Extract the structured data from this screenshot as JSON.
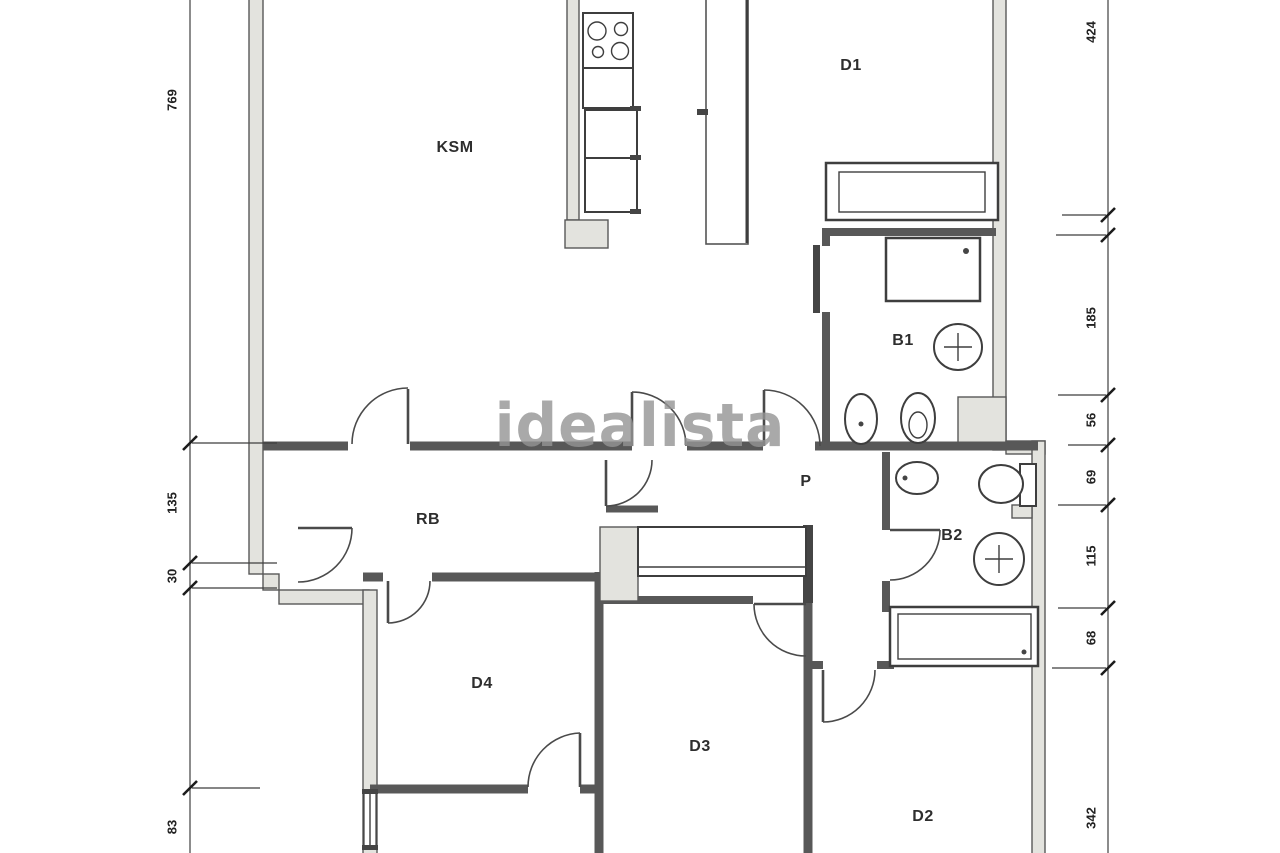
{
  "watermark": "idealista",
  "rooms": [
    {
      "id": "ksm",
      "label": "KSM"
    },
    {
      "id": "d1",
      "label": "D1"
    },
    {
      "id": "b1",
      "label": "B1"
    },
    {
      "id": "p",
      "label": "P"
    },
    {
      "id": "rb",
      "label": "RB"
    },
    {
      "id": "b2",
      "label": "B2"
    },
    {
      "id": "d4",
      "label": "D4"
    },
    {
      "id": "d3",
      "label": "D3"
    },
    {
      "id": "d2",
      "label": "D2"
    }
  ],
  "dimensions": {
    "left": [
      {
        "value": "769"
      },
      {
        "value": "135"
      },
      {
        "value": "30"
      },
      {
        "value": "83"
      }
    ],
    "right": [
      {
        "value": "424"
      },
      {
        "value": "185"
      },
      {
        "value": "56"
      },
      {
        "value": "69"
      },
      {
        "value": "115"
      },
      {
        "value": "68"
      },
      {
        "value": "342"
      }
    ]
  },
  "fixtures": [
    "stove-icon",
    "kitchen-counter",
    "wardrobe-d1",
    "shower-b1",
    "sink-b1",
    "bidet-b1",
    "toilet-b1",
    "bidet-b2",
    "toilet-b2",
    "sink-b2",
    "hall-wardrobe",
    "cabinet-d2",
    "window-d4"
  ],
  "colors": {
    "background": "#ffffff",
    "wall_fill": "#e3e3de",
    "wall_line": "#585858",
    "fixture_line": "#3e3e3e",
    "dimension_line": "#3f3f3f",
    "watermark": "#949494"
  }
}
